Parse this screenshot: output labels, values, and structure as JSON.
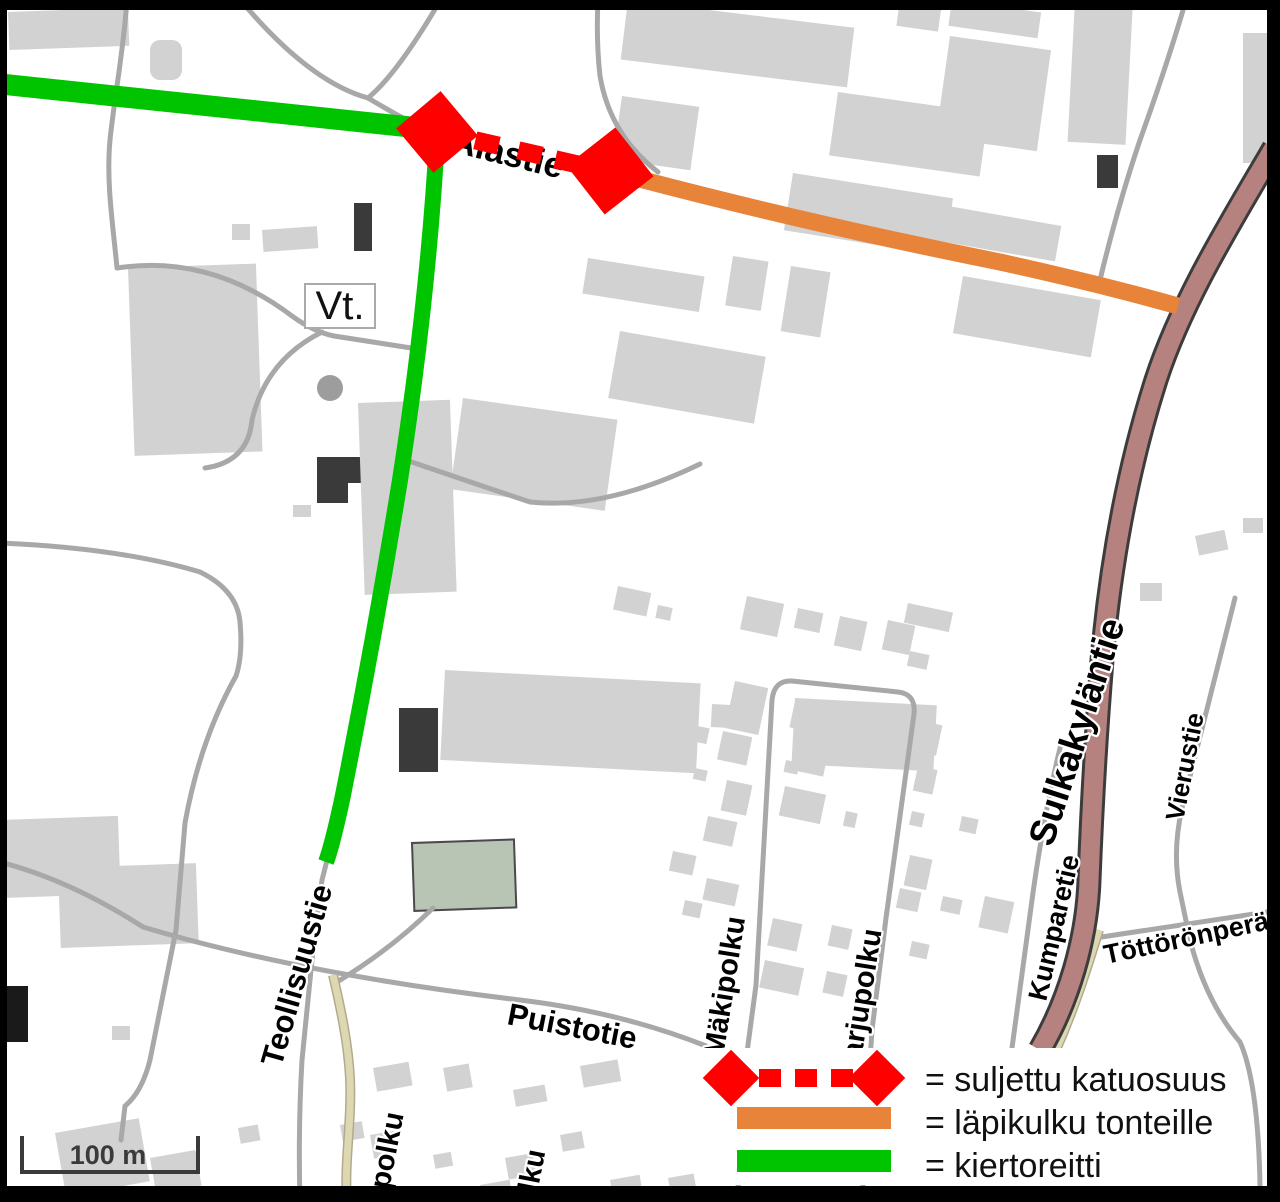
{
  "map": {
    "street_labels": {
      "alastie": "Alastie",
      "teollisuustie": "Teollisuustie",
      "puistotie": "Puistotie",
      "makipolku": "Mäkipolku",
      "harjupolku": "Harjupolku",
      "polku_partial_1": "polku",
      "polku_partial_2": "olku",
      "sulkakylantie": "Sulkakyläntie",
      "vierustie": "Vierustie",
      "kumparetie": "Kumparetie",
      "tottoronpera": "Töttörönperä"
    },
    "road_sign": "Vt.",
    "scale_bar_label": "100 m"
  },
  "legend": {
    "items": [
      {
        "symbol": "closed-street-section",
        "label": "= suljettu katuosuus",
        "color": "#fe0000"
      },
      {
        "symbol": "through-access-to-plots",
        "label": "= läpikulku tonteille",
        "color": "#e8843a"
      },
      {
        "symbol": "detour-route",
        "label": "= kiertoreitti",
        "color": "#00c400"
      }
    ]
  },
  "colors": {
    "closed_red": "#fe0000",
    "access_orange": "#e8843a",
    "detour_green": "#00c400",
    "road_brown": "#b5827f",
    "building_gray": "#d2d2d2",
    "path_beige": "#ded8b2"
  }
}
